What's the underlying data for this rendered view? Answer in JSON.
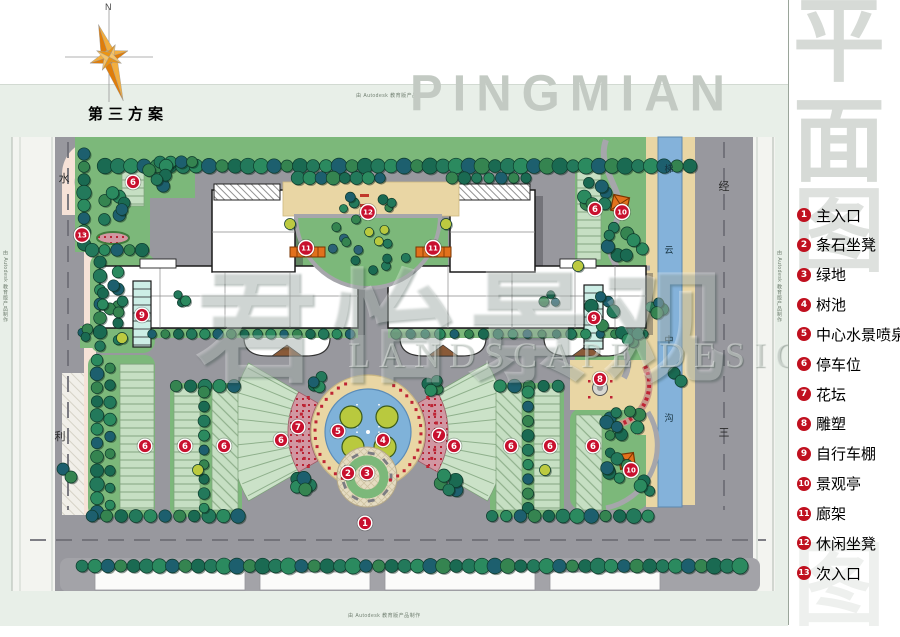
{
  "sheet": {
    "title": "第三方案",
    "compass_label": "N",
    "watermark_latin": "PINGMIAN",
    "watermark_vertical_chars": [
      "平",
      "面",
      "图"
    ],
    "brand_watermark_cjk": "君怡景观",
    "brand_watermark_latin": "LANDSCAPE DESIGN",
    "plot_stamp": "由 Autodesk 教育版产品制作"
  },
  "labels": {
    "left_road": [
      "水",
      "利"
    ],
    "right_road": [
      "经",
      "三"
    ],
    "canal": [
      "梯",
      "云",
      "中",
      "沟"
    ]
  },
  "legend": {
    "items": [
      {
        "num": "1",
        "label": "主入口"
      },
      {
        "num": "2",
        "label": "条石坐凳"
      },
      {
        "num": "3",
        "label": "绿地"
      },
      {
        "num": "4",
        "label": "树池"
      },
      {
        "num": "5",
        "label": "中心水景喷泉"
      },
      {
        "num": "6",
        "label": "停车位"
      },
      {
        "num": "7",
        "label": "花坛"
      },
      {
        "num": "8",
        "label": "雕塑"
      },
      {
        "num": "9",
        "label": "自行车棚"
      },
      {
        "num": "10",
        "label": "景观亭"
      },
      {
        "num": "11",
        "label": "廊架"
      },
      {
        "num": "12",
        "label": "休闲坐凳"
      },
      {
        "num": "13",
        "label": "次入口"
      }
    ]
  },
  "plan_markers": [
    {
      "num": "1",
      "x": 365,
      "y": 523
    },
    {
      "num": "2",
      "x": 348,
      "y": 473
    },
    {
      "num": "3",
      "x": 367,
      "y": 473
    },
    {
      "num": "4",
      "x": 383,
      "y": 440
    },
    {
      "num": "5",
      "x": 338,
      "y": 431
    },
    {
      "num": "6",
      "x": 133,
      "y": 182
    },
    {
      "num": "6",
      "x": 595,
      "y": 209
    },
    {
      "num": "6",
      "x": 281,
      "y": 440
    },
    {
      "num": "6",
      "x": 454,
      "y": 446
    },
    {
      "num": "6",
      "x": 145,
      "y": 446
    },
    {
      "num": "6",
      "x": 185,
      "y": 446
    },
    {
      "num": "6",
      "x": 224,
      "y": 446
    },
    {
      "num": "6",
      "x": 511,
      "y": 446
    },
    {
      "num": "6",
      "x": 550,
      "y": 446
    },
    {
      "num": "6",
      "x": 593,
      "y": 446
    },
    {
      "num": "7",
      "x": 298,
      "y": 427
    },
    {
      "num": "7",
      "x": 439,
      "y": 435
    },
    {
      "num": "8",
      "x": 600,
      "y": 379
    },
    {
      "num": "9",
      "x": 142,
      "y": 315
    },
    {
      "num": "9",
      "x": 594,
      "y": 318
    },
    {
      "num": "10",
      "x": 622,
      "y": 212
    },
    {
      "num": "10",
      "x": 631,
      "y": 470
    },
    {
      "num": "11",
      "x": 306,
      "y": 248
    },
    {
      "num": "11",
      "x": 433,
      "y": 248
    },
    {
      "num": "12",
      "x": 368,
      "y": 212
    },
    {
      "num": "13",
      "x": 82,
      "y": 235
    }
  ],
  "colors": {
    "marker_red": "#c8102e",
    "legend_red": "#c0101f",
    "road_gray": "#98989e",
    "lawn_green": "#7cb87a",
    "parking_green": "#c6dfc3",
    "tree_green": "#1e6e55",
    "water_blue": "#84b2da",
    "walk_tan": "#e9d6a4",
    "flower_pink": "#d197a2",
    "pavilion_orange": "#e2711c",
    "compass_orange": "#ef9d2a",
    "watermark_gray": "#c3cac3",
    "sheet_green": "#e8efe8"
  }
}
